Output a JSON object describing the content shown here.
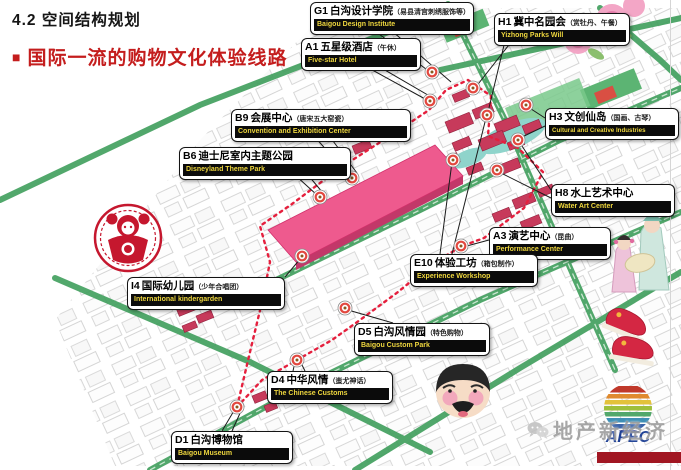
{
  "slide": {
    "title": "4.2 空间结构规划",
    "bullet": "■",
    "subtitle": "国际一流的购物文化体验线路",
    "accent_color": "#c41d1d"
  },
  "callouts": [
    {
      "code": "G1",
      "name": "白沟设计学院",
      "note": "（易县清宫刺绣服饰等）",
      "name_en": "Baigou Design Institute"
    },
    {
      "code": "H1",
      "name": "冀中名园会",
      "note": "（赏牡丹、午餐）",
      "name_en": "Yizhong Parks Will"
    },
    {
      "code": "A1",
      "name": "五星级酒店",
      "note": "（午休）",
      "name_en": "Five-star Hotel"
    },
    {
      "code": "B9",
      "name": "会展中心",
      "note": "（唐宋五大窑瓷）",
      "name_en": "Convention and Exhibition Center"
    },
    {
      "code": "B6",
      "name": "迪士尼室内主题公园",
      "note": "",
      "name_en": "Disneyland Theme Park"
    },
    {
      "code": "H3",
      "name": "文创仙岛",
      "note": "（国画、古琴）",
      "name_en": "Cultural and Creative Industries"
    },
    {
      "code": "H8",
      "name": "水上艺术中心",
      "note": "",
      "name_en": "Water Art Center"
    },
    {
      "code": "A3",
      "name": "演艺中心",
      "note": "（昆曲）",
      "name_en": "Performance Center"
    },
    {
      "code": "E10",
      "name": "体验工坊",
      "note": "（箱包制作）",
      "name_en": "Experience Workshop"
    },
    {
      "code": "I4",
      "name": "国际幼儿园",
      "note": "（少年合唱团）",
      "name_en": "International kindergarden"
    },
    {
      "code": "D5",
      "name": "白沟风情园",
      "note": "（特色购物）",
      "name_en": "Baigou Custom Park"
    },
    {
      "code": "D4",
      "name": "中华风情",
      "note": "（蚩尤神话）",
      "name_en": "The Chinese Customs"
    },
    {
      "code": "D1",
      "name": "白沟博物馆",
      "note": "",
      "name_en": "Baigou Museum"
    }
  ],
  "map": {
    "route_color": "#e51f3d",
    "road_color": "#3f9e5c",
    "mall_color": "#ee5a8e",
    "building_color": "#c73a5b"
  },
  "decorations": [
    "papercut-art",
    "peony-flowers",
    "opera-performers",
    "water-art",
    "red-embroidered-shoes",
    "opera-mask"
  ],
  "watermark": {
    "text": "地产新经济"
  },
  "logo": {
    "text": "APEC"
  }
}
